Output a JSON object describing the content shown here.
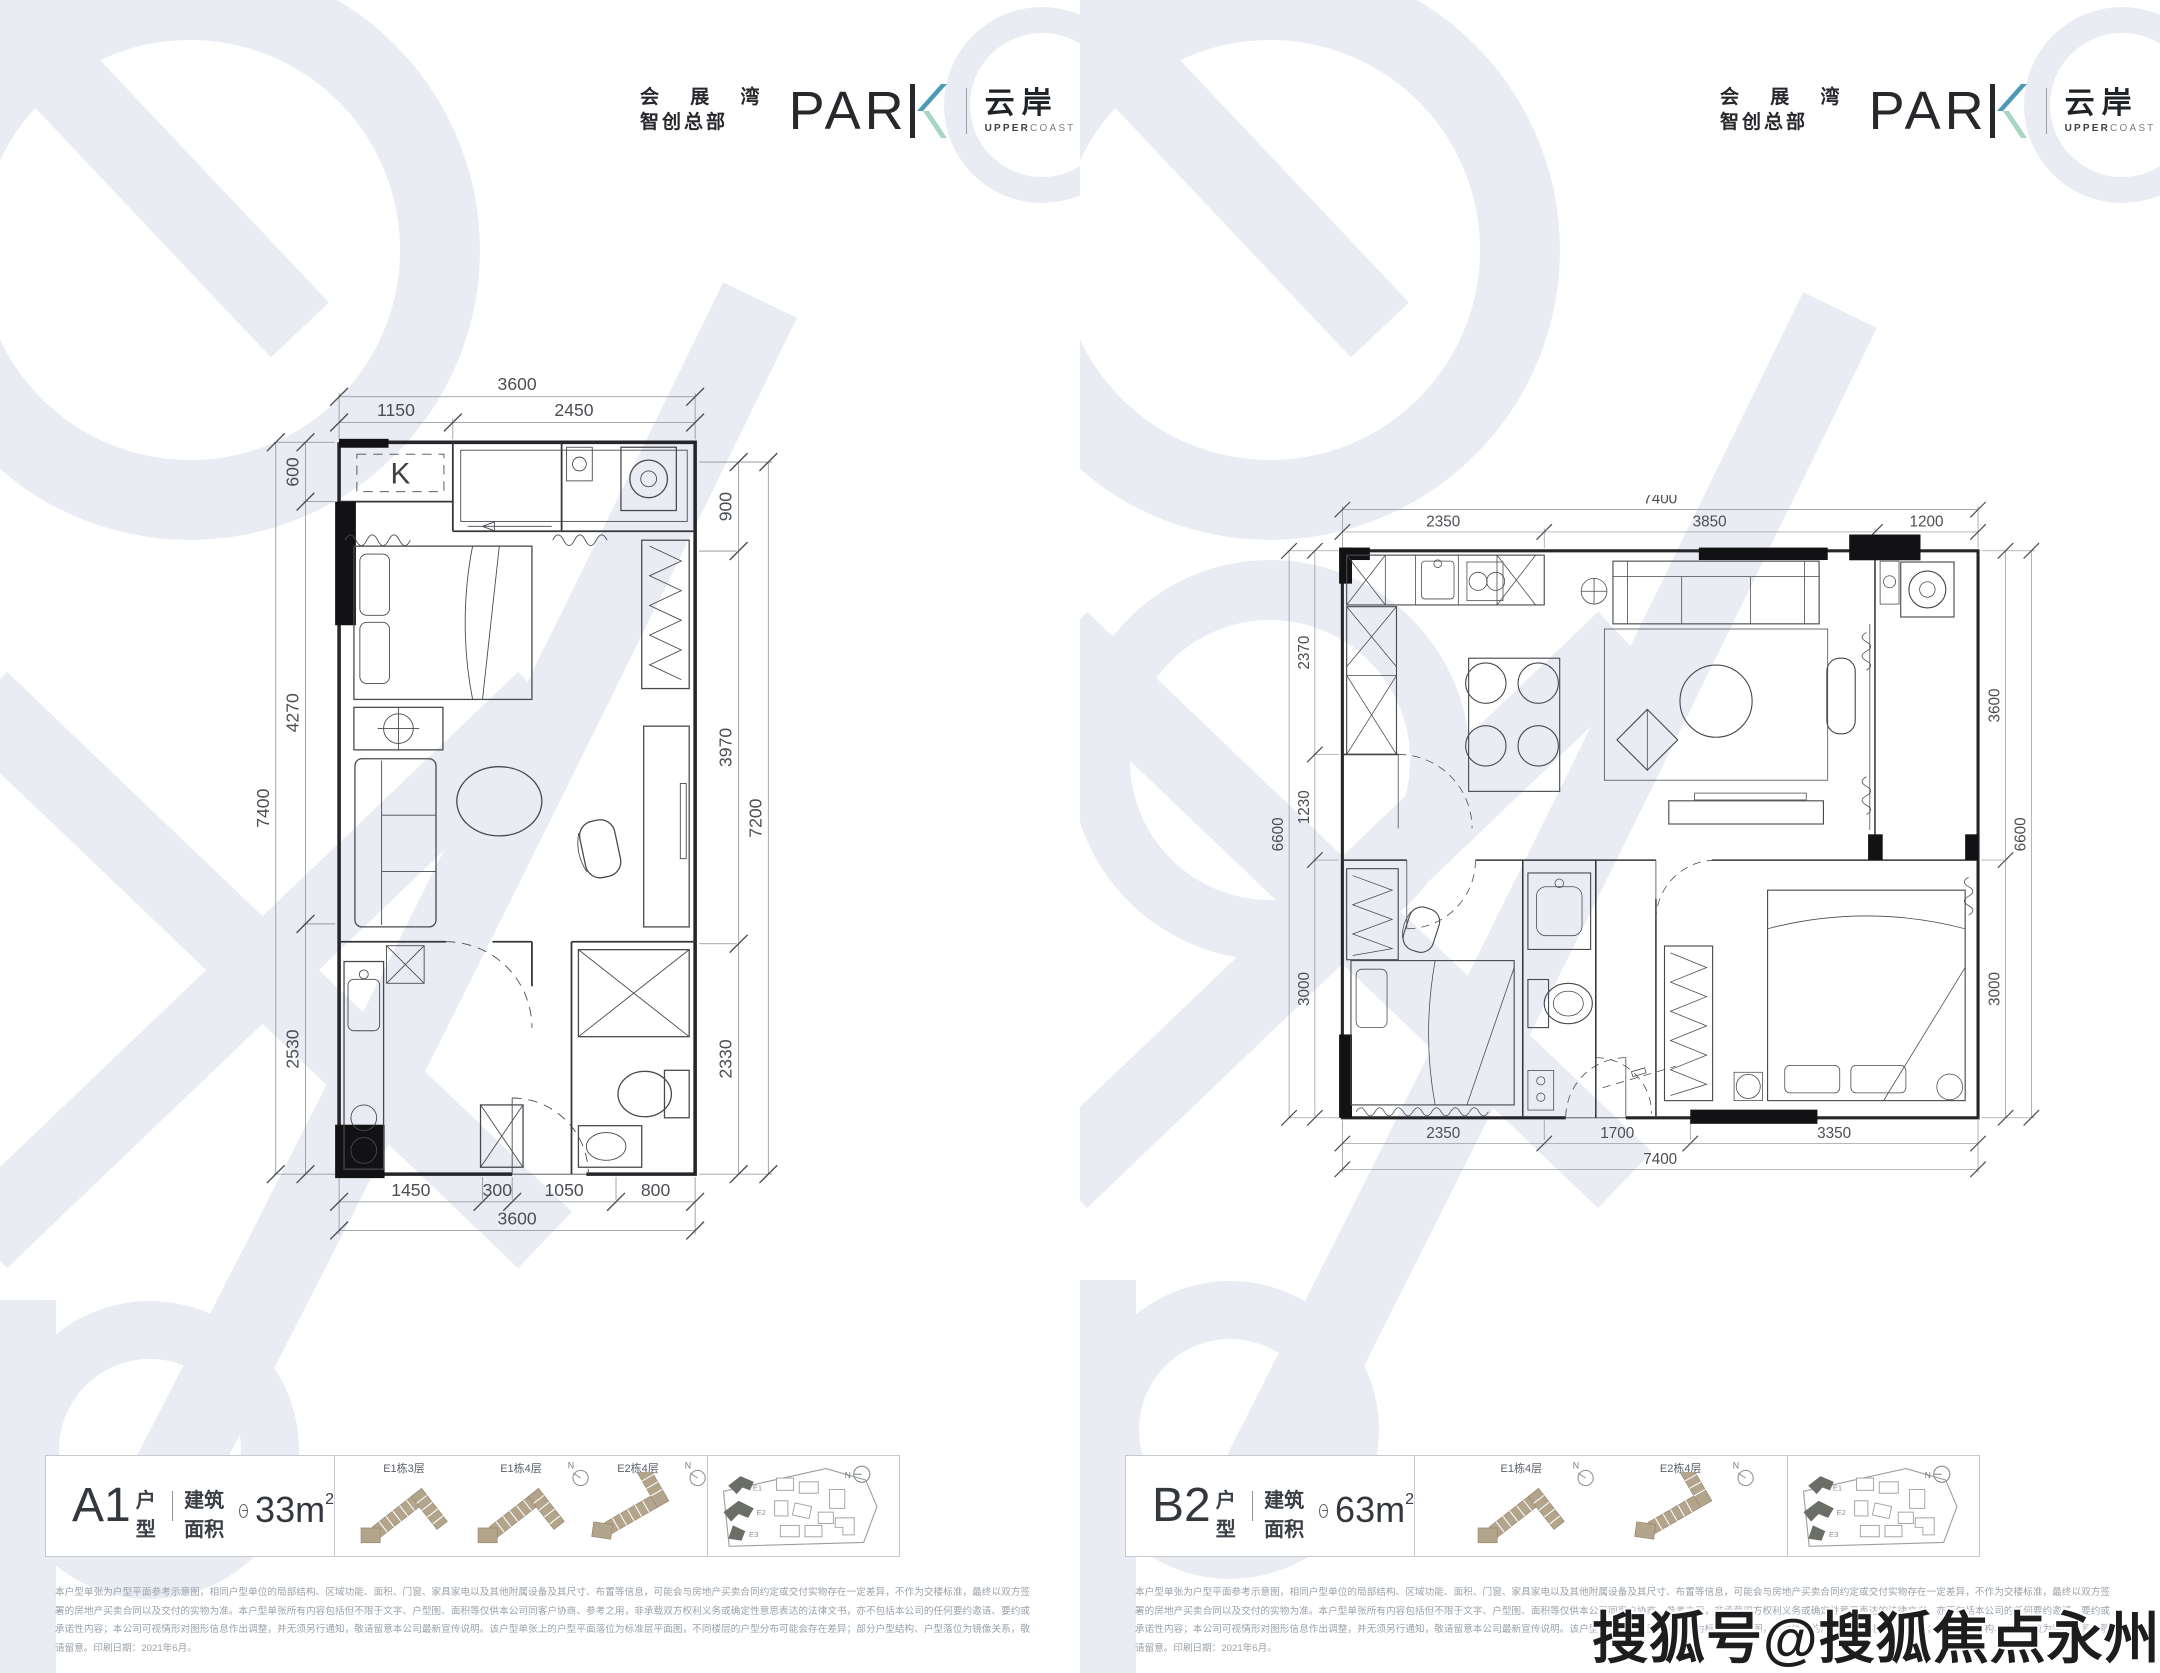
{
  "brand": {
    "cn1": "会 展 湾",
    "cn2": "智创总部",
    "park_prefix": "PAR",
    "park": "PARK",
    "name_cn": "云岸",
    "name_en_bold": "UPPER",
    "name_en_light": "COAST"
  },
  "plan_a1": {
    "title": "A1",
    "type_suffix": "户型",
    "area_label": "建筑面积",
    "area_value": "33m",
    "area_sup": "2",
    "k_label": "K",
    "dims": {
      "top_total": "3600",
      "top_1": "1150",
      "top_2": "2450",
      "left_total": "7400",
      "left_1": "600",
      "left_2": "4270",
      "left_3": "2530",
      "right_total": "7200",
      "right_1": "900",
      "right_2": "3970",
      "right_3": "2330",
      "bottom_total": "3600",
      "bottom_1": "1450",
      "bottom_2": "300",
      "bottom_3": "1050",
      "bottom_4": "800"
    },
    "locators": [
      {
        "label": "E1栋3层"
      },
      {
        "label": "E1栋4层"
      },
      {
        "label": "E2栋4层"
      }
    ]
  },
  "plan_b2": {
    "title": "B2",
    "type_suffix": "户型",
    "area_label": "建筑面积",
    "area_value": "63m",
    "area_sup": "2",
    "dims": {
      "top_total": "7400",
      "top_1": "2350",
      "top_2": "3850",
      "top_3": "1200",
      "left_total": "6600",
      "left_1": "2370",
      "left_2": "1230",
      "left_3": "3000",
      "right_total": "6600",
      "right_1": "3600",
      "right_2": "3000",
      "bottom_total": "7400",
      "bottom_1": "2350",
      "bottom_2": "1700",
      "bottom_3": "3350"
    },
    "locators": [
      {
        "label": "E1栋4层"
      },
      {
        "label": "E2栋4层"
      }
    ]
  },
  "siteplan": {
    "b1": "E1",
    "b2": "E2",
    "b3": "E3"
  },
  "compass": {
    "label": "N"
  },
  "disclaimer": {
    "text": "本户型单张为户型平面参考示意图，相同户型单位的局部结构、区域功能、面积、门窗、家具家电以及其他附属设备及其尺寸、布置等信息，可能会与房地产买卖合同约定或交付实物存在一定差异，不作为交楼标准，最终以双方签署的房地产买卖合同以及交付的实物为准。本户型单张所有内容包括但不限于文字、户型图、面积等仅供本公司同客户协商、参考之用，非承载双方权利义务或确定性意思表达的法律文书，亦不包括本公司的任何要约邀请、要约或承诺性内容；本公司可视情形对图形信息作出调整，并无须另行通知，敬请留意本公司最新宣传说明。该户型单张上的户型平面落位为标准层平面图，不同楼层的户型分布可能会存在差异；部分户型结构、户型落位为镜像关系，敬请留意。印刷日期：2021年6月。"
  },
  "watermark": {
    "sohu": "搜狐号@搜狐焦点永州站",
    "brand_letters": "expobay"
  }
}
